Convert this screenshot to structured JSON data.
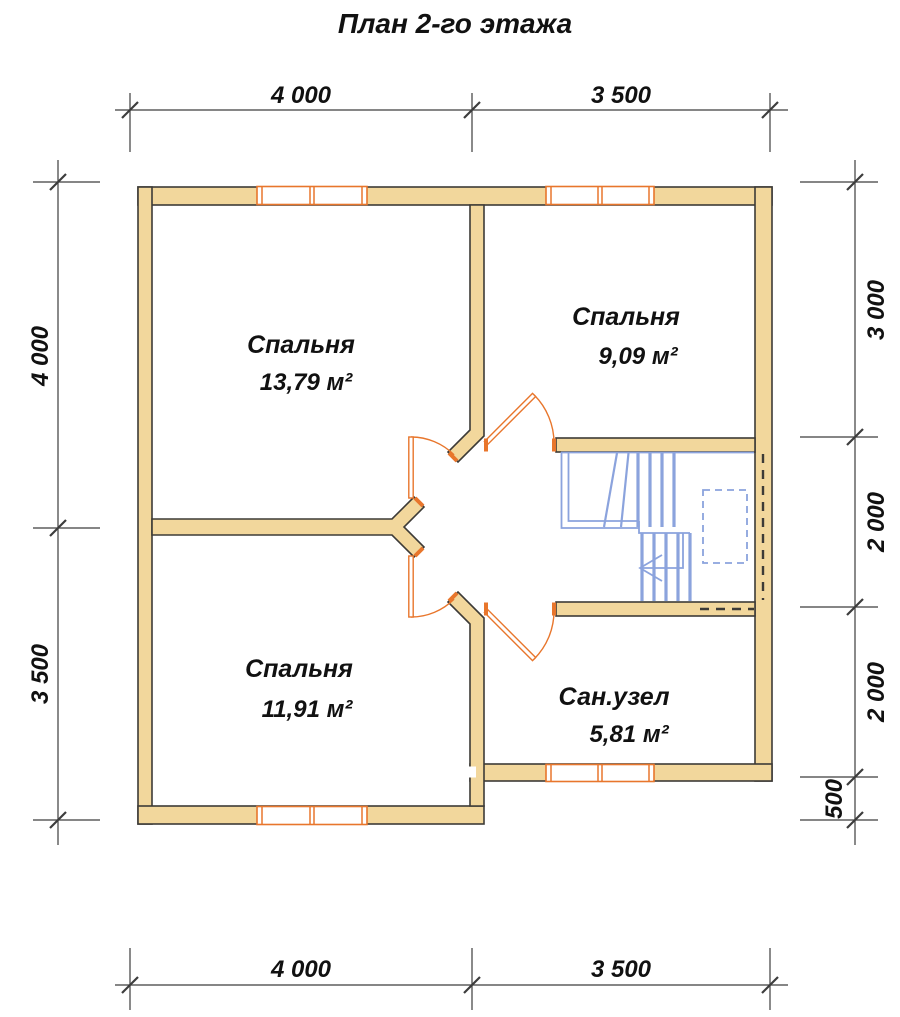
{
  "title": "План 2-го этажа",
  "rooms": [
    {
      "id": "bedroom-1",
      "name": "Спальня",
      "area": "13,79 м²"
    },
    {
      "id": "bedroom-2",
      "name": "Спальня",
      "area": "9,09 м²"
    },
    {
      "id": "bedroom-3",
      "name": "Спальня",
      "area": "11,91 м²"
    },
    {
      "id": "bathroom",
      "name": "Сан.узел",
      "area": "5,81 м²"
    }
  ],
  "dimensions": {
    "top": [
      "4 000",
      "3 500"
    ],
    "bottom": [
      "4 000",
      "3 500"
    ],
    "left": [
      "4 000",
      "3 500"
    ],
    "right": [
      "3 000",
      "2 000",
      "2 000",
      "500"
    ]
  },
  "colors": {
    "background": "#ffffff",
    "wall-fill": "#f2d79c",
    "wall-stroke": "#3d3b37",
    "joinery": "#e8762c",
    "stairs": "#8ba3dd",
    "dim": "#3d3d3d",
    "text": "#111111"
  }
}
